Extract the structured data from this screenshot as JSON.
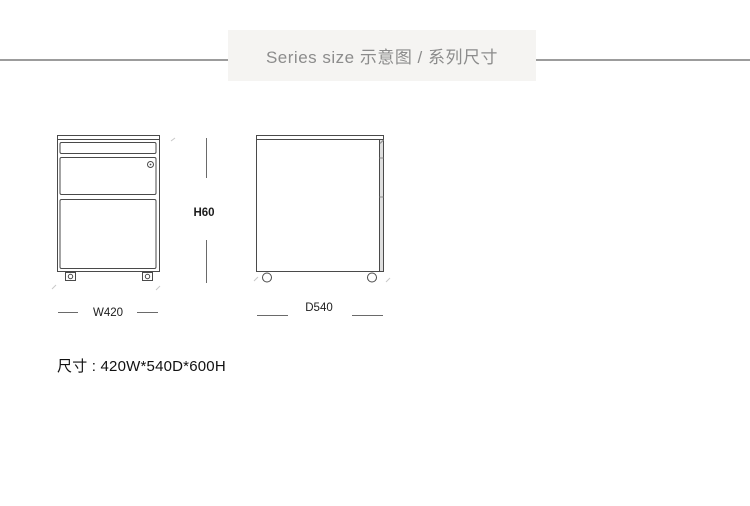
{
  "header": {
    "title": "Series size 示意图 / 系列尺寸"
  },
  "diagram": {
    "height_label": "H60",
    "front_view": {
      "width_label": "W420"
    },
    "side_view": {
      "depth_label": "D540"
    }
  },
  "footer": {
    "dimensions_label": "尺寸 : 420W*540D*600H"
  },
  "colors": {
    "header_background": "#f5f4f2",
    "header_text": "#8c8c8c",
    "divider_line": "#9c9c9c",
    "drawing_line": "#4a4a4a",
    "dimension_text": "#1c1c1c"
  }
}
